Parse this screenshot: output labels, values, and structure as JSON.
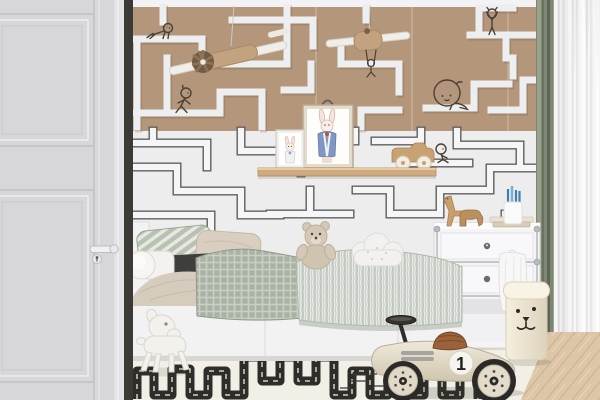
{
  "scene": {
    "title": "children-bedroom-with-maze-wallpaper",
    "race_car": {
      "number": "1"
    },
    "colors": {
      "wall-tan": "#b4977b",
      "wall-white": "#ededee",
      "maze-line-light": "#eceef0",
      "maze-outline": "#5f5f5f",
      "door-gray": "#d7d6d8",
      "curtain-green": "#7e8774",
      "floor-wood": "#dcc6a7",
      "rug-ivory": "#f2efe7",
      "road-black": "#2e2d29",
      "blanket-sage": "#a9b2a3",
      "car-cream": "#e6dfcd",
      "seat-brown": "#9a6238",
      "doodle-ink": "#4a4036"
    },
    "objects": {
      "door": "white paneled door",
      "wallpaper": "maze wallpaper tan over white",
      "doodles": [
        "crawling figure",
        "walking figure",
        "yoga figure",
        "large sitting figure",
        "small sitting figure",
        "hanging figure"
      ],
      "airplanes": "two hanging wooden toy airplanes",
      "shelf": "picture ledge with two bunny prints and wooden toy car",
      "bed": "bed with sage waffle blanket, pillows, bolster, teddy bear, cloud pillow",
      "dresser": "white modular dresser with wooden animal toys, books, pencil cup",
      "basket": "bear face laundry basket",
      "rug": "ivory rug with black road track",
      "toys": [
        "white puppy rocking toy",
        "vintage ride-on race car"
      ]
    }
  }
}
